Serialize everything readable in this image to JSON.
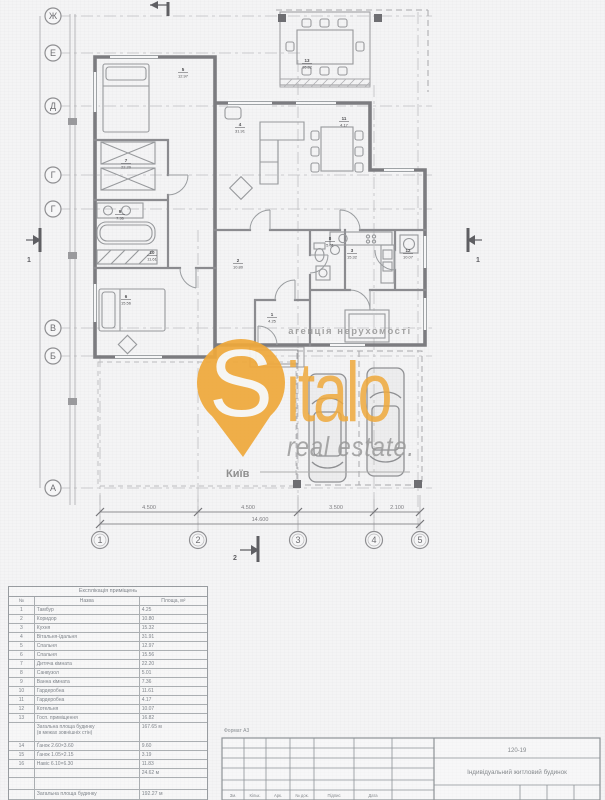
{
  "watermark": {
    "brand_s": "S",
    "brand_rest": "italo",
    "tagline": "real estate.",
    "agency_line": "агенція нерухомості",
    "city": "Київ",
    "orange": "#EFA93C",
    "gray": "#9A9A9A"
  },
  "axes": {
    "rows": [
      "Ж",
      "Е",
      "Д",
      "Г",
      "Г",
      "В",
      "Б",
      "А"
    ],
    "cols": [
      "1",
      "2",
      "3",
      "4",
      "5"
    ]
  },
  "dimensions": {
    "segments": [
      "4.500",
      "4.500",
      "3.500",
      "2.100"
    ],
    "total": "14.600"
  },
  "sections": {
    "left": "1",
    "right": "1",
    "bottom": "2"
  },
  "plan": {
    "room_labels": [
      {
        "n": "1",
        "a": "4.25"
      },
      {
        "n": "2",
        "a": "10.80"
      },
      {
        "n": "3",
        "a": "15.32"
      },
      {
        "n": "4",
        "a": "31.91"
      },
      {
        "n": "5",
        "a": "12.97"
      },
      {
        "n": "6",
        "a": "15.56"
      },
      {
        "n": "7",
        "a": "22.20"
      },
      {
        "n": "8",
        "a": "5.01"
      },
      {
        "n": "9",
        "a": "7.36"
      },
      {
        "n": "10",
        "a": "11.61"
      },
      {
        "n": "11",
        "a": "4.17"
      },
      {
        "n": "12",
        "a": "10.07"
      },
      {
        "n": "13",
        "a": "16.82"
      }
    ]
  },
  "schedule": {
    "title": "Експлікація приміщень",
    "col_num": "№",
    "col_name": "Назва",
    "col_area": "Площа, м²",
    "rows": [
      {
        "n": "1",
        "name": "Тамбур",
        "area": "4.25"
      },
      {
        "n": "2",
        "name": "Коридор",
        "area": "10.80"
      },
      {
        "n": "3",
        "name": "Кухня",
        "area": "15.32"
      },
      {
        "n": "4",
        "name": "Вітальня-їдальня",
        "area": "31.91"
      },
      {
        "n": "5",
        "name": "Спальня",
        "area": "12.97"
      },
      {
        "n": "6",
        "name": "Спальня",
        "area": "15.56"
      },
      {
        "n": "7",
        "name": "Дитяча кімната",
        "area": "22.20"
      },
      {
        "n": "8",
        "name": "Санвузол",
        "area": "5.01"
      },
      {
        "n": "9",
        "name": "Ванна кімната",
        "area": "7.36"
      },
      {
        "n": "10",
        "name": "Гардеробна",
        "area": "11.61"
      },
      {
        "n": "11",
        "name": "Гардеробна",
        "area": "4.17"
      },
      {
        "n": "12",
        "name": "Котельня",
        "area": "10.07"
      },
      {
        "n": "13",
        "name": "Госп. приміщення",
        "area": "16.82"
      }
    ],
    "subtotal_label1": "Загальна площа будинку",
    "subtotal_label2": "(в межах зовнішніх стін)",
    "subtotal_value": "167.65 м",
    "extra": [
      {
        "n": "14",
        "name": "Ґанок 2.60×3.60",
        "area": "9.60"
      },
      {
        "n": "15",
        "name": "Ґанок 1.05×2.15",
        "area": "3.19"
      },
      {
        "n": "16",
        "name": "Навіс 6.10×6.30",
        "area": "11.83"
      }
    ],
    "extra_total": "24.62 м",
    "total_label": "Загальна площа будинку",
    "total_value": "192.27 м"
  },
  "titleblock": {
    "format_label": "Формат А3",
    "code": "120-19",
    "project": "Індивідуальний житловий будинок",
    "footer": [
      "Зм.",
      "Кільк.",
      "Арк.",
      "№ док.",
      "Підпис",
      "Дата"
    ]
  }
}
